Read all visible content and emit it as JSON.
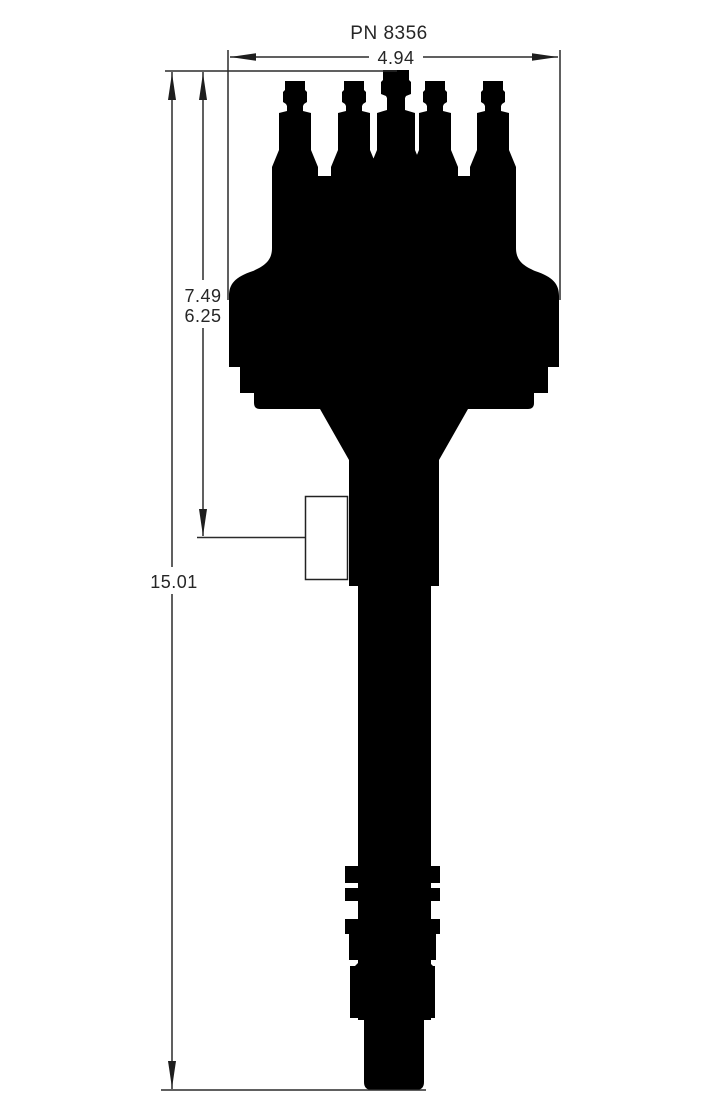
{
  "drawing": {
    "title": "PN 8356",
    "figure": "distributor-side-profile-silhouette",
    "dimensions": {
      "width": "4.94",
      "upper_height_a": "7.49",
      "upper_height_b": "6.25",
      "overall_height": "15.01"
    },
    "colors": {
      "background": "#ffffff",
      "silhouette": "#000000",
      "dimension_lines": "#2b2b2b",
      "text": "#262626"
    }
  }
}
